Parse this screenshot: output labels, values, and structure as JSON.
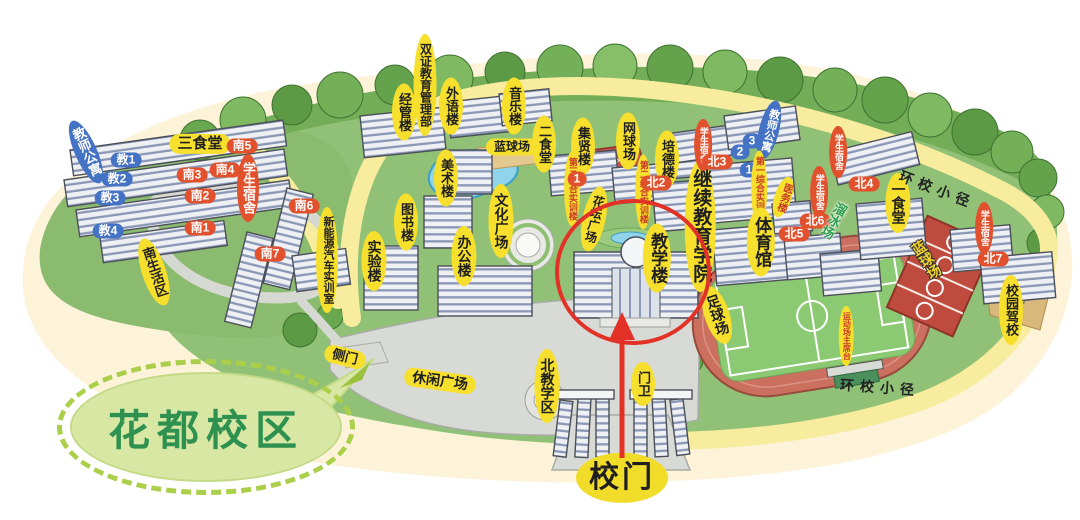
{
  "campus_bubble": {
    "label": "花都校区"
  },
  "palette": {
    "label_yellow": "#f6df2d",
    "label_red": "#e2512d",
    "label_blue": "#4472c4",
    "bubble_green_text": "#2e9150",
    "highlight_red": "#e23127",
    "path_yellow": "#f8ec9e",
    "grass_green": "#90c176",
    "track_red": "#cb6f5f"
  },
  "labels": [
    {
      "n": "label-sanshitang",
      "k": "yh",
      "t": "三食堂",
      "x": 200,
      "y": 144,
      "s": 15
    },
    {
      "n": "label-nan5",
      "k": "rp",
      "t": "南5",
      "x": 242,
      "y": 146
    },
    {
      "n": "label-jiaoshigongyu-left",
      "k": "bv",
      "t": "教师公寓",
      "x": 86,
      "y": 152,
      "r": -24,
      "s": 13
    },
    {
      "n": "label-jiao1",
      "k": "bp",
      "t": "教1",
      "x": 126,
      "y": 160
    },
    {
      "n": "label-jiao2",
      "k": "bp",
      "t": "教2",
      "x": 117,
      "y": 179
    },
    {
      "n": "label-jiao3",
      "k": "bp",
      "t": "教3",
      "x": 110,
      "y": 198
    },
    {
      "n": "label-jiao4",
      "k": "bp",
      "t": "教4",
      "x": 108,
      "y": 231
    },
    {
      "n": "label-nan3",
      "k": "rp",
      "t": "南3",
      "x": 192,
      "y": 175
    },
    {
      "n": "label-nan4",
      "k": "rp",
      "t": "南4",
      "x": 225,
      "y": 170
    },
    {
      "n": "label-xueshengsushe-south",
      "k": "rv",
      "t": "学生宿舍",
      "x": 248,
      "y": 188,
      "s": 13
    },
    {
      "n": "label-nan2",
      "k": "rp",
      "t": "南2",
      "x": 200,
      "y": 196
    },
    {
      "n": "label-nan1",
      "k": "rp",
      "t": "南1",
      "x": 200,
      "y": 228
    },
    {
      "n": "label-nan6",
      "k": "rp",
      "t": "南6",
      "x": 304,
      "y": 206
    },
    {
      "n": "label-nan7",
      "k": "rp",
      "t": "南7",
      "x": 270,
      "y": 254
    },
    {
      "n": "label-nanshenghuoqu",
      "k": "yv",
      "t": "南生活区",
      "x": 154,
      "y": 272,
      "r": -18,
      "s": 13
    },
    {
      "n": "label-xinnengyuan-shixunshi",
      "k": "yv",
      "t": "新能源汽车实训室",
      "x": 327,
      "y": 260,
      "s": 11
    },
    {
      "n": "label-cemen",
      "k": "yh",
      "t": "侧门",
      "x": 345,
      "y": 357,
      "r": 14,
      "s": 13
    },
    {
      "n": "label-shuangzheng-jiaoyu-guanlibu",
      "k": "yv",
      "t": "双证教育管理部",
      "x": 425,
      "y": 85,
      "s": 12
    },
    {
      "n": "label-jingguanlou",
      "k": "yv",
      "t": "经管楼",
      "x": 404,
      "y": 112,
      "s": 13
    },
    {
      "n": "label-waiyulou",
      "k": "yv",
      "t": "外语楼",
      "x": 451,
      "y": 106,
      "s": 13
    },
    {
      "n": "label-yinyuelou",
      "k": "yv",
      "t": "音乐楼",
      "x": 514,
      "y": 106,
      "s": 13
    },
    {
      "n": "label-lanqiuchang-pond",
      "k": "yh",
      "t": "蓝球场",
      "x": 512,
      "y": 147,
      "s": 12
    },
    {
      "n": "label-ershitang",
      "k": "yv",
      "t": "二食堂",
      "x": 544,
      "y": 144,
      "s": 13
    },
    {
      "n": "label-jixianlou",
      "k": "yv",
      "t": "集贤楼",
      "x": 583,
      "y": 146,
      "s": 13
    },
    {
      "n": "label-meishulou",
      "k": "yv",
      "t": "美术楼",
      "x": 446,
      "y": 178,
      "s": 13
    },
    {
      "n": "label-tushulou",
      "k": "yv",
      "t": "图书楼",
      "x": 406,
      "y": 222,
      "s": 13
    },
    {
      "n": "label-shiyanlou",
      "k": "yv",
      "t": "实验楼",
      "x": 374,
      "y": 261,
      "s": 14
    },
    {
      "n": "label-bangonglou",
      "k": "yv",
      "t": "办公楼",
      "x": 464,
      "y": 256,
      "s": 14
    },
    {
      "n": "label-wenhuaguangchang",
      "k": "yv",
      "t": "文化广场",
      "x": 501,
      "y": 221,
      "s": 14
    },
    {
      "n": "label-huatanguangchang",
      "k": "yv",
      "t": "花坛广场",
      "x": 594,
      "y": 219,
      "r": 12,
      "s": 12
    },
    {
      "n": "label-disan-zonghe-shixunlou",
      "k": "yrv",
      "t": "第三综合实训楼",
      "x": 572,
      "y": 189,
      "s": 9
    },
    {
      "n": "label-marker-1-center",
      "k": "rp",
      "t": "1",
      "x": 577,
      "y": 179
    },
    {
      "n": "label-wangqiuchang",
      "k": "yv",
      "t": "网球场",
      "x": 628,
      "y": 141,
      "s": 13
    },
    {
      "n": "label-peidelou",
      "k": "yv",
      "t": "培德楼",
      "x": 667,
      "y": 159,
      "s": 13
    },
    {
      "n": "label-dier-zonghe-shixunlou",
      "k": "yrv",
      "t": "第二综合实训楼",
      "x": 643,
      "y": 192,
      "s": 9
    },
    {
      "n": "label-bei2",
      "k": "rp",
      "t": "北2",
      "x": 656,
      "y": 183
    },
    {
      "n": "label-jiaoxuelou",
      "k": "yv",
      "t": "教学楼",
      "x": 657,
      "y": 258,
      "s": 17
    },
    {
      "n": "label-jixu-jiaoyu-xueyuan",
      "k": "yv",
      "t": "继续教育学院",
      "x": 700,
      "y": 226,
      "s": 19
    },
    {
      "n": "label-xueshengsushe-bei3",
      "k": "rv",
      "t": "学生宿舍",
      "x": 703,
      "y": 145,
      "s": 9
    },
    {
      "n": "label-bei3",
      "k": "rp",
      "t": "北3",
      "x": 717,
      "y": 162
    },
    {
      "n": "label-jiaoshigongyu-right",
      "k": "bv",
      "t": "教师公寓",
      "x": 769,
      "y": 130,
      "r": 14,
      "s": 11
    },
    {
      "n": "label-pill-3",
      "k": "bp",
      "t": "3",
      "x": 752,
      "y": 141
    },
    {
      "n": "label-pill-2",
      "k": "bp",
      "t": "2",
      "x": 740,
      "y": 152
    },
    {
      "n": "label-pill-1",
      "k": "bp",
      "t": "1",
      "x": 749,
      "y": 170
    },
    {
      "n": "label-diyi-zonghe-shixunlou",
      "k": "yrv",
      "t": "第一综合实训楼",
      "x": 759,
      "y": 188,
      "s": 9
    },
    {
      "n": "label-yiwulou",
      "k": "yrv",
      "t": "医务楼",
      "x": 783,
      "y": 197,
      "r": 18,
      "s": 10
    },
    {
      "n": "label-tiyuguan",
      "k": "yv",
      "t": "体育馆",
      "x": 761,
      "y": 242,
      "s": 17
    },
    {
      "n": "label-xueshengsushe-bei4",
      "k": "rv",
      "t": "学生宿舍",
      "x": 838,
      "y": 152,
      "s": 9
    },
    {
      "n": "label-bei4",
      "k": "rp",
      "t": "北4",
      "x": 864,
      "y": 184
    },
    {
      "n": "label-xueshengsushe-bei6",
      "k": "rv",
      "t": "学生宿舍",
      "x": 819,
      "y": 192,
      "s": 9
    },
    {
      "n": "label-bei6",
      "k": "rp",
      "t": "北6",
      "x": 815,
      "y": 221
    },
    {
      "n": "label-bei5",
      "k": "rp",
      "t": "北5",
      "x": 794,
      "y": 234
    },
    {
      "n": "label-liubingchang",
      "k": "gt",
      "t": "溜冰场",
      "x": 833,
      "y": 220,
      "r": 28,
      "s": 13
    },
    {
      "n": "label-yishitang",
      "k": "yv",
      "t": "一食堂",
      "x": 898,
      "y": 203,
      "s": 14
    },
    {
      "n": "label-huanxiao-xiaojing-top",
      "k": "pt",
      "t": "环校小径",
      "x": 937,
      "y": 190,
      "r": 21,
      "s": 14
    },
    {
      "n": "label-xueshengsushe-bei7",
      "k": "rv",
      "t": "学生宿舍",
      "x": 984,
      "y": 228,
      "s": 9
    },
    {
      "n": "label-bei7",
      "k": "rp",
      "t": "北7",
      "x": 993,
      "y": 259
    },
    {
      "n": "label-lanqiuchang-courts",
      "k": "ct",
      "t": "蓝球场",
      "x": 926,
      "y": 260,
      "r": -32,
      "s": 14
    },
    {
      "n": "label-xiaoyuan-jiaxiao",
      "k": "yv",
      "t": "校园驾校",
      "x": 1011,
      "y": 310,
      "s": 13
    },
    {
      "n": "label-zuqiuchang",
      "k": "yv",
      "t": "足球场",
      "x": 717,
      "y": 315,
      "r": -18,
      "s": 14
    },
    {
      "n": "label-yundongchang-zhuxitai",
      "k": "yrv",
      "t": "运动场主席台",
      "x": 846,
      "y": 336,
      "s": 8
    },
    {
      "n": "label-huanxiao-xiaojing-bottom",
      "k": "pt",
      "t": "环校小径",
      "x": 880,
      "y": 388,
      "r": 4,
      "s": 14
    },
    {
      "n": "label-xiuxian-guangchang",
      "k": "yh",
      "t": "休闲广场",
      "x": 440,
      "y": 381,
      "r": 8,
      "s": 14
    },
    {
      "n": "label-bei-jiaoxuequ",
      "k": "yv",
      "t": "北教学区",
      "x": 547,
      "y": 386,
      "s": 14
    },
    {
      "n": "label-menwei",
      "k": "yv",
      "t": "门卫",
      "x": 643,
      "y": 384,
      "s": 13
    },
    {
      "n": "label-xiaomen",
      "k": "gate",
      "t": "校门",
      "x": 622,
      "y": 478,
      "s": 30
    }
  ]
}
